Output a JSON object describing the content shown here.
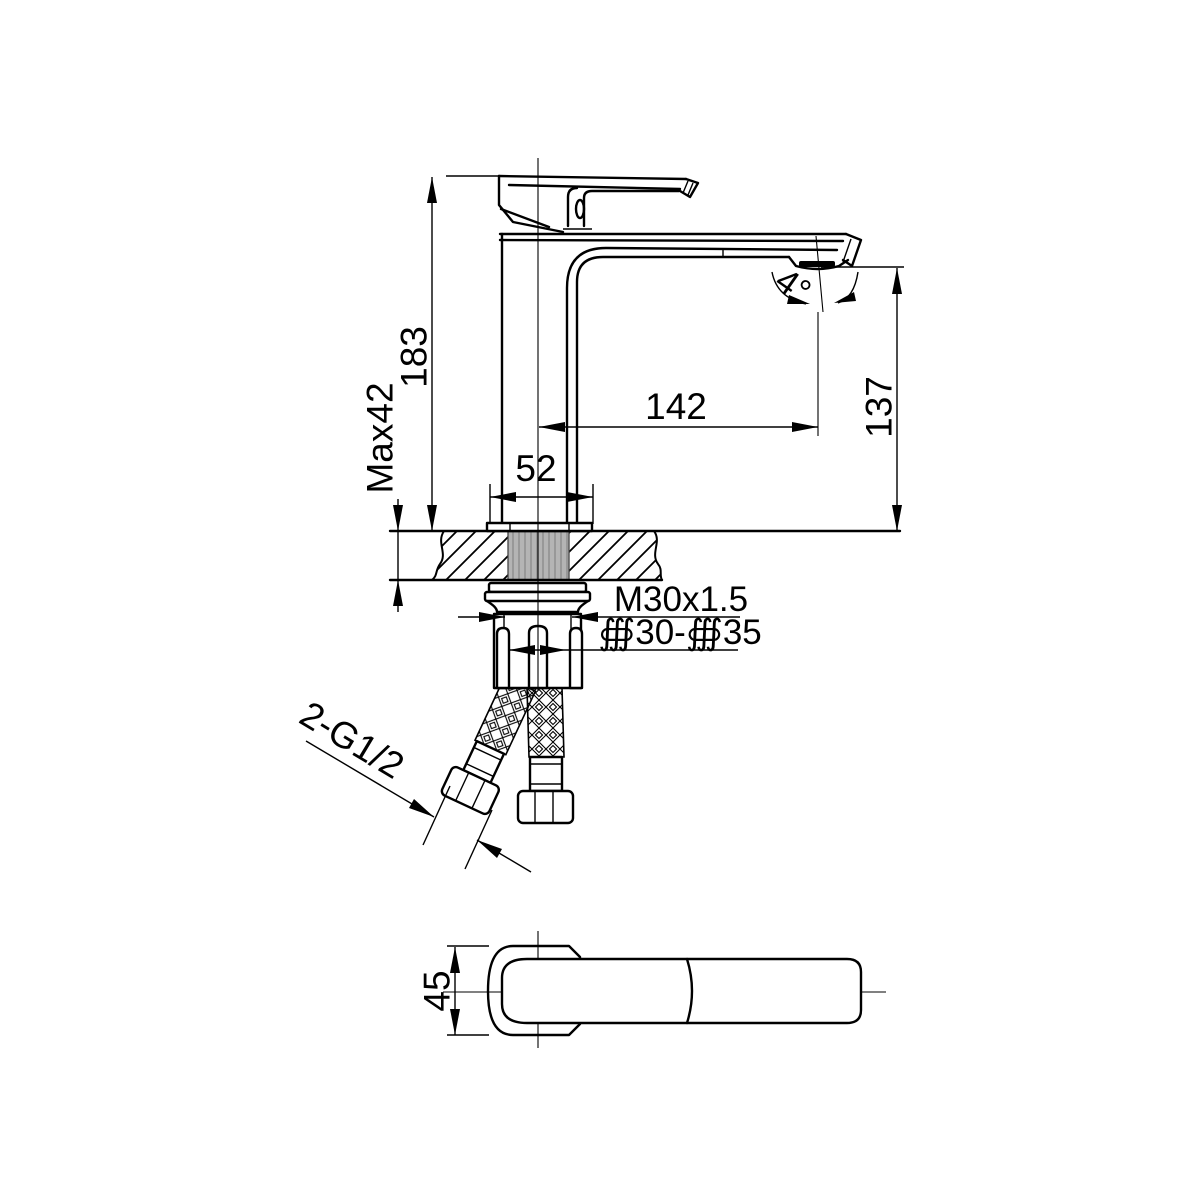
{
  "drawing": {
    "title": "Basin faucet installation dimension drawing",
    "dims": {
      "overall_height": "183",
      "max_deck_thickness": "Max42",
      "spout_reach": "142",
      "outlet_height": "137",
      "base_width": "52",
      "aerator_angle": "4°",
      "shank_thread": "M30x1.5",
      "mounting_hole": "∰30-∰35",
      "hose_thread": "2-G1/2",
      "body_depth": "45"
    },
    "colors": {
      "line": "#000000",
      "background": "#ffffff",
      "thread_fill": "#b4b4b4"
    }
  }
}
